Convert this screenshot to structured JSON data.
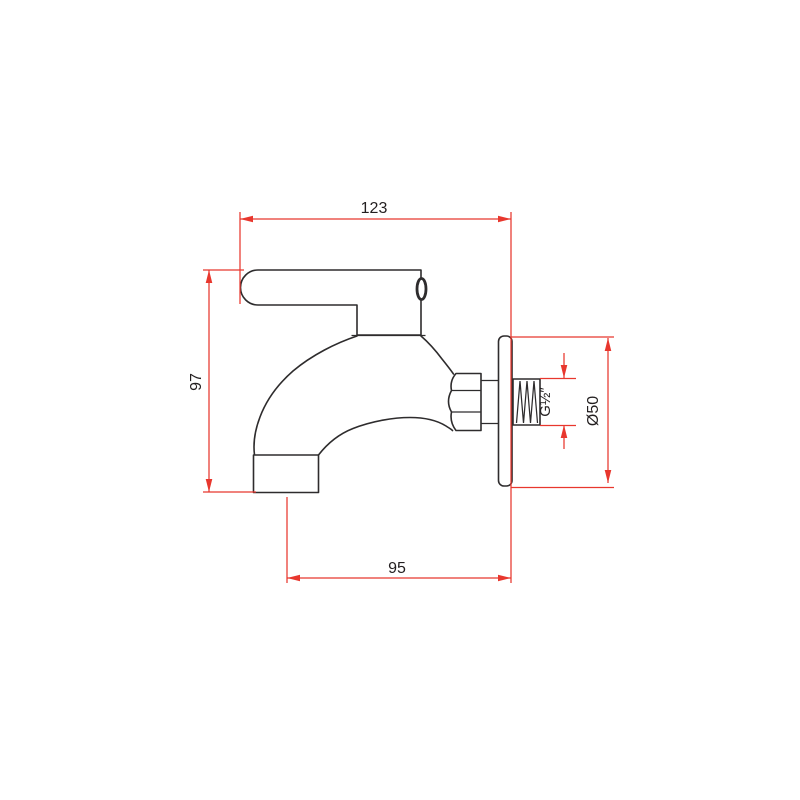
{
  "drawing": {
    "colors": {
      "outline": "#2e2c2d",
      "dimension": "#e8372e",
      "background": "#ffffff",
      "text": "#231f20"
    },
    "labels": {
      "total_width": "123",
      "total_height": "97",
      "spout_offset": "95",
      "flange_diameter": "Ø50",
      "thread_size": "G½″"
    }
  }
}
